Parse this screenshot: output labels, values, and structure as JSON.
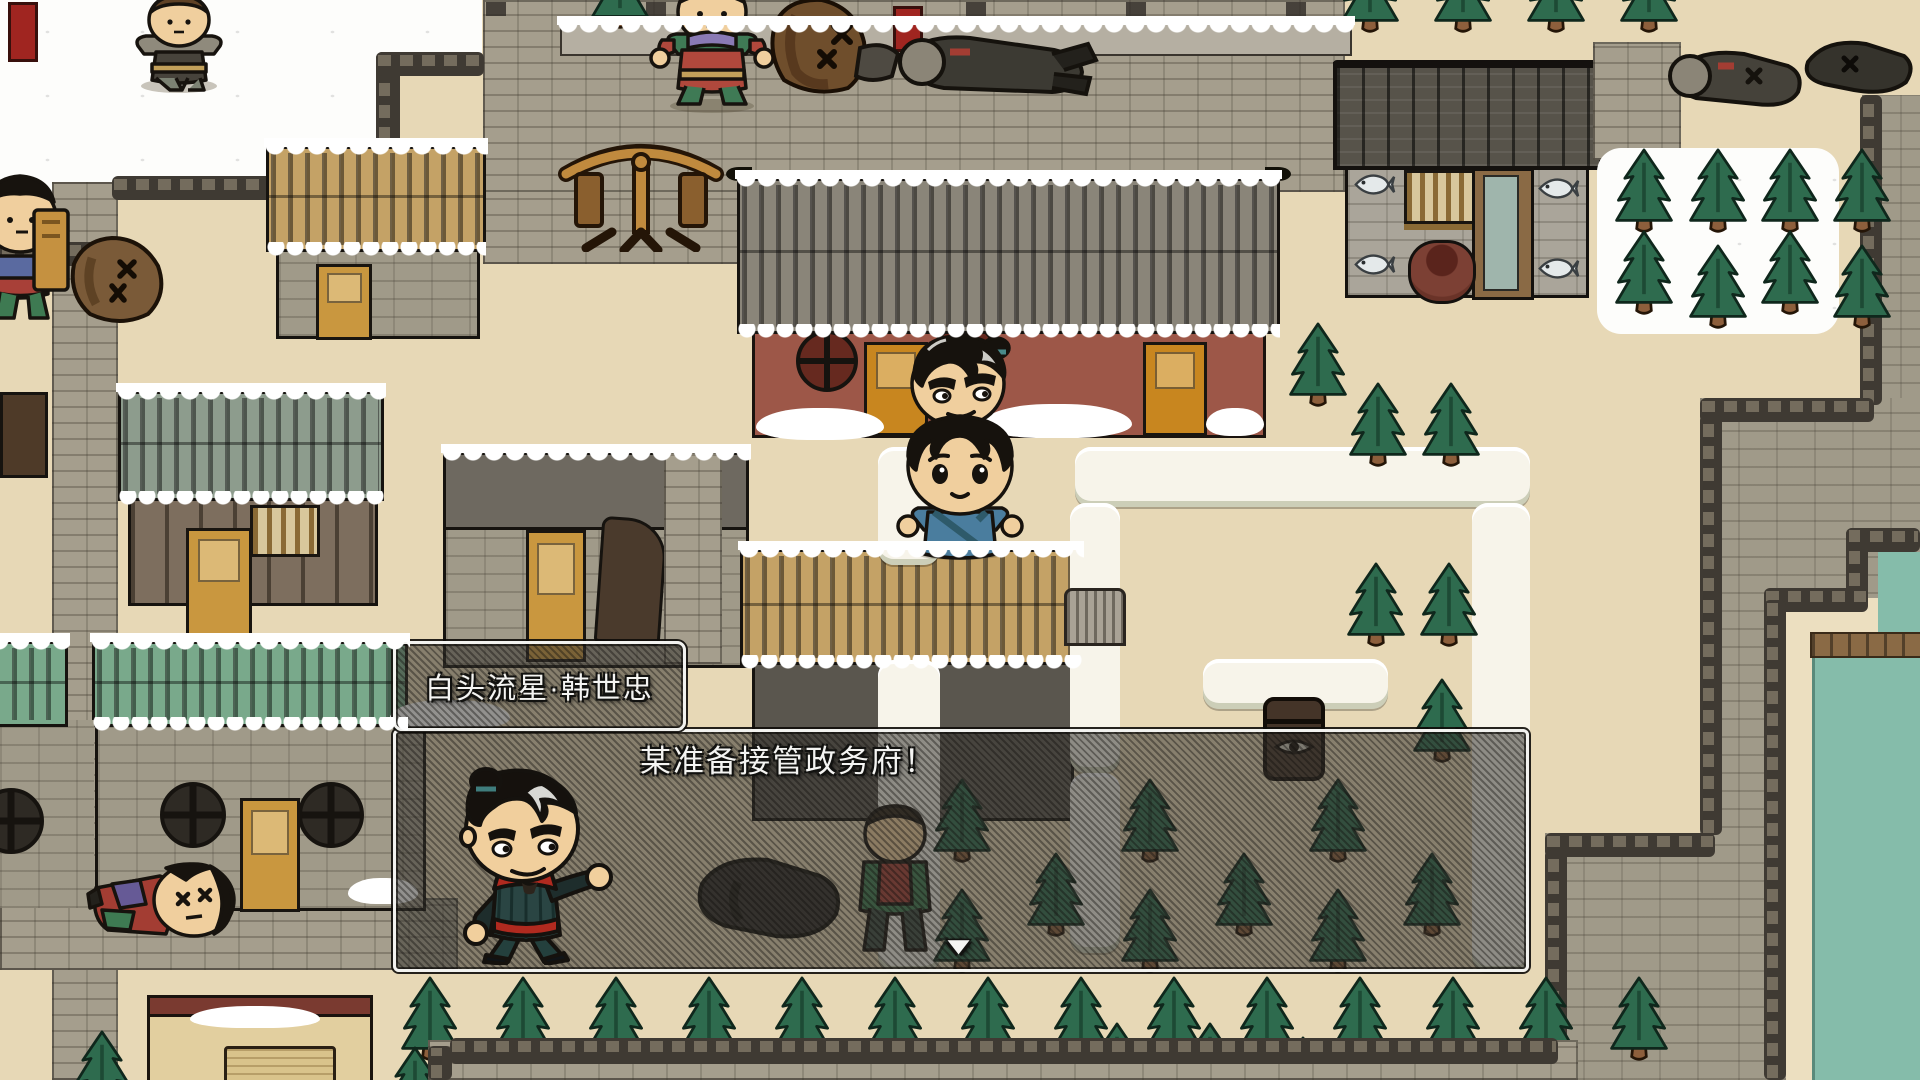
{
  "dialogue": {
    "speaker_name": "白头流星·韩世忠",
    "message": "某准备接管政务府！",
    "continue_indicator": "▼"
  },
  "icons": {
    "continue_icon": "down-triangle",
    "chest_icon": "eye-chest",
    "shop_sign_icons": "fish"
  },
  "colors": {
    "ui_border": "#f2f2ef",
    "ui_box_bg": "rgba(56,54,50,0.55)",
    "ui_text": "#f4f4f2",
    "ground_tan": "#e7d8b6",
    "snow_white": "#fdfdfb",
    "road_grey": "#a59e8d",
    "wall_dark": "#3f3a33",
    "red_building": "#9d5748",
    "gold_thatch": "#c4a266",
    "sage_thatch": "#8d9c8d",
    "green_thatch": "#79a98b",
    "pine_green": "#2e6b4e",
    "trunk_brown": "#8d5f3c",
    "water_teal": "#85bcaa",
    "portrait_armor": "#2a4543",
    "portrait_sash": "#b02a1f"
  }
}
